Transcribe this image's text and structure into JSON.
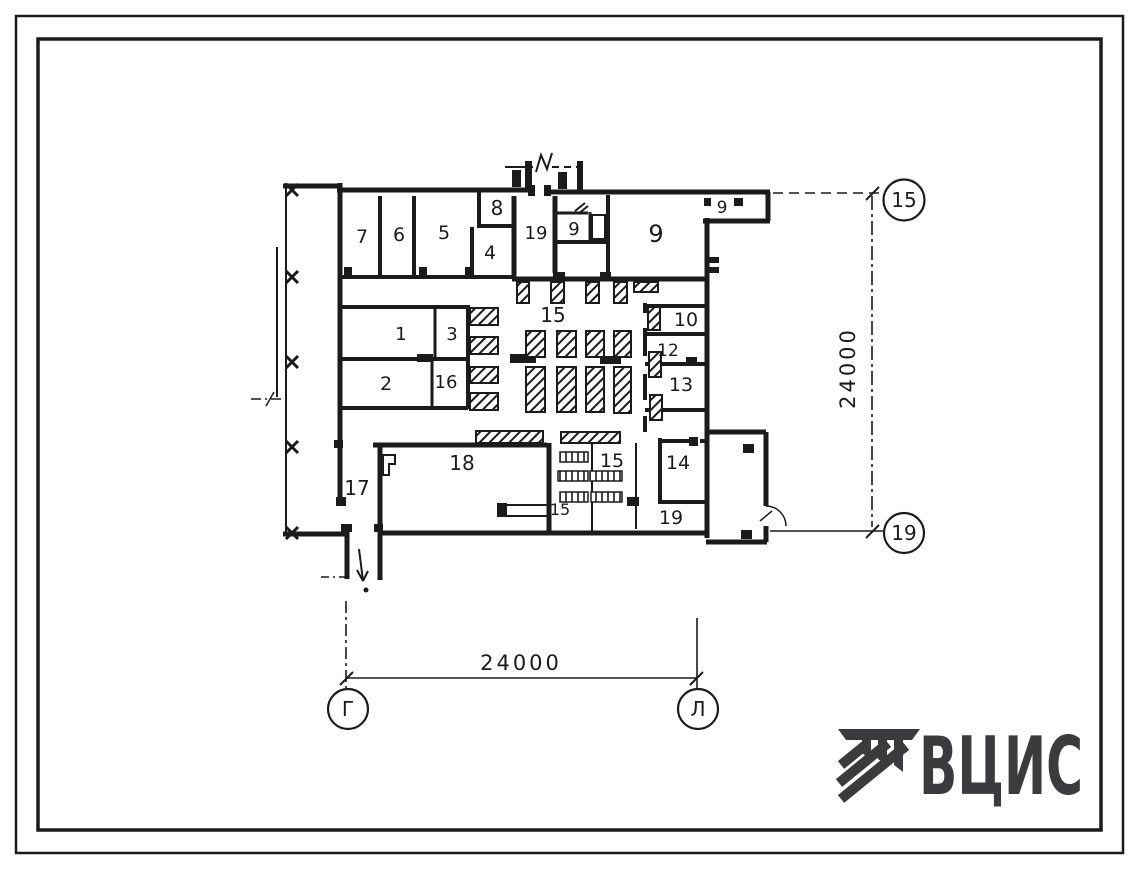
{
  "sheet": {
    "background": "#ffffff",
    "ink_color": "#1b1b1b",
    "logo_color": "#3b3b3d"
  },
  "plan": {
    "room_labels": [
      {
        "id": "room-7",
        "label": "7"
      },
      {
        "id": "room-6",
        "label": "6"
      },
      {
        "id": "room-5",
        "label": "5"
      },
      {
        "id": "room-8",
        "label": "8"
      },
      {
        "id": "room-4",
        "label": "4"
      },
      {
        "id": "room-19-top",
        "label": "19"
      },
      {
        "id": "room-9-small",
        "label": "9"
      },
      {
        "id": "room-9-large",
        "label": "9"
      },
      {
        "id": "room-9-annex",
        "label": "9"
      },
      {
        "id": "room-1",
        "label": "1"
      },
      {
        "id": "room-3",
        "label": "3"
      },
      {
        "id": "room-2",
        "label": "2"
      },
      {
        "id": "room-16",
        "label": "16"
      },
      {
        "id": "hall-15",
        "label": "15"
      },
      {
        "id": "room-10",
        "label": "10"
      },
      {
        "id": "room-12",
        "label": "12"
      },
      {
        "id": "room-13",
        "label": "13"
      },
      {
        "id": "room-17",
        "label": "17"
      },
      {
        "id": "room-18",
        "label": "18"
      },
      {
        "id": "room-15-lower",
        "label": "15"
      },
      {
        "id": "room-15-small",
        "label": "15"
      },
      {
        "id": "room-14",
        "label": "14"
      },
      {
        "id": "room-19-bottom",
        "label": "19"
      }
    ],
    "dimensions": {
      "right": {
        "value": "24000"
      },
      "bottom": {
        "value": "24000"
      }
    },
    "axes": {
      "top_right": "15",
      "bottom_right": "19",
      "bottom_left": "Г",
      "bottom_center": "Л"
    }
  },
  "logo": {
    "text": "ВЦИС"
  }
}
